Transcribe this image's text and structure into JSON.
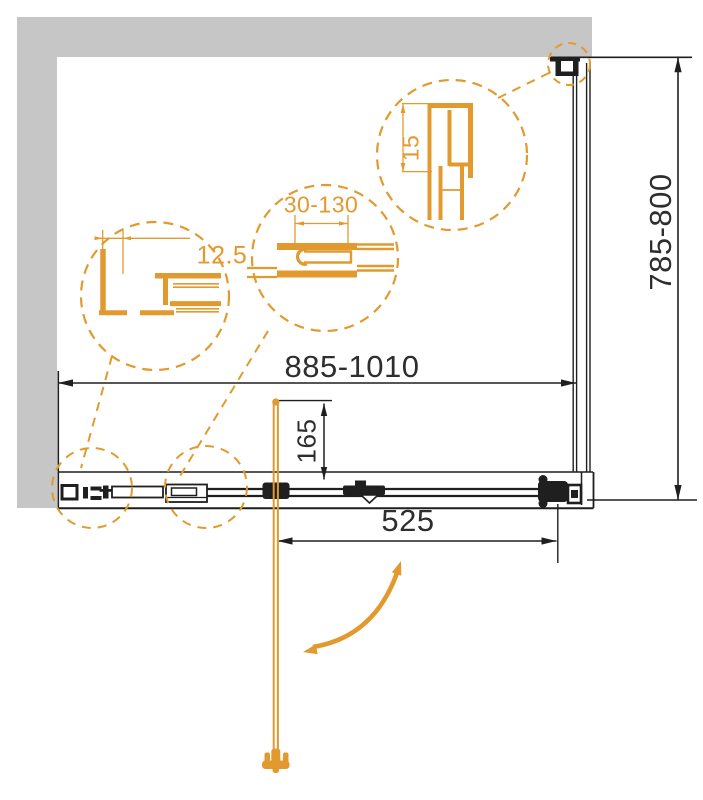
{
  "drawing": {
    "dimensions": {
      "overall_width": "885-1010",
      "side_panel_depth": "785-800",
      "handle_to_rail": "165",
      "door_opening": "525"
    },
    "details": {
      "wall_profile_offset": "12.5",
      "adjustment_range": "30-130",
      "profile_size": "15"
    },
    "colors": {
      "accent_orange": "#E29A2E",
      "wall_gray": "#C6C6C6",
      "line_black": "#1F1F1F"
    }
  }
}
